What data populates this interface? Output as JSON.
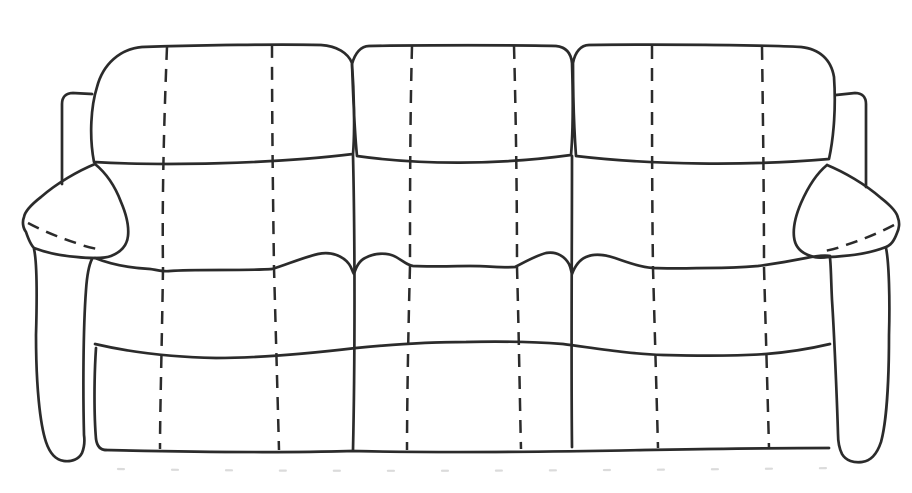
{
  "drawing": {
    "subject": "three-seat reclining sofa line drawing, front view",
    "background_color": "#ffffff",
    "stroke_color": "#2b2b2b",
    "shadow_color": "#bdbdbd",
    "back_cushion_count": 3,
    "seat_count": 3,
    "arm_count": 2,
    "stitch_line_count": 6
  }
}
